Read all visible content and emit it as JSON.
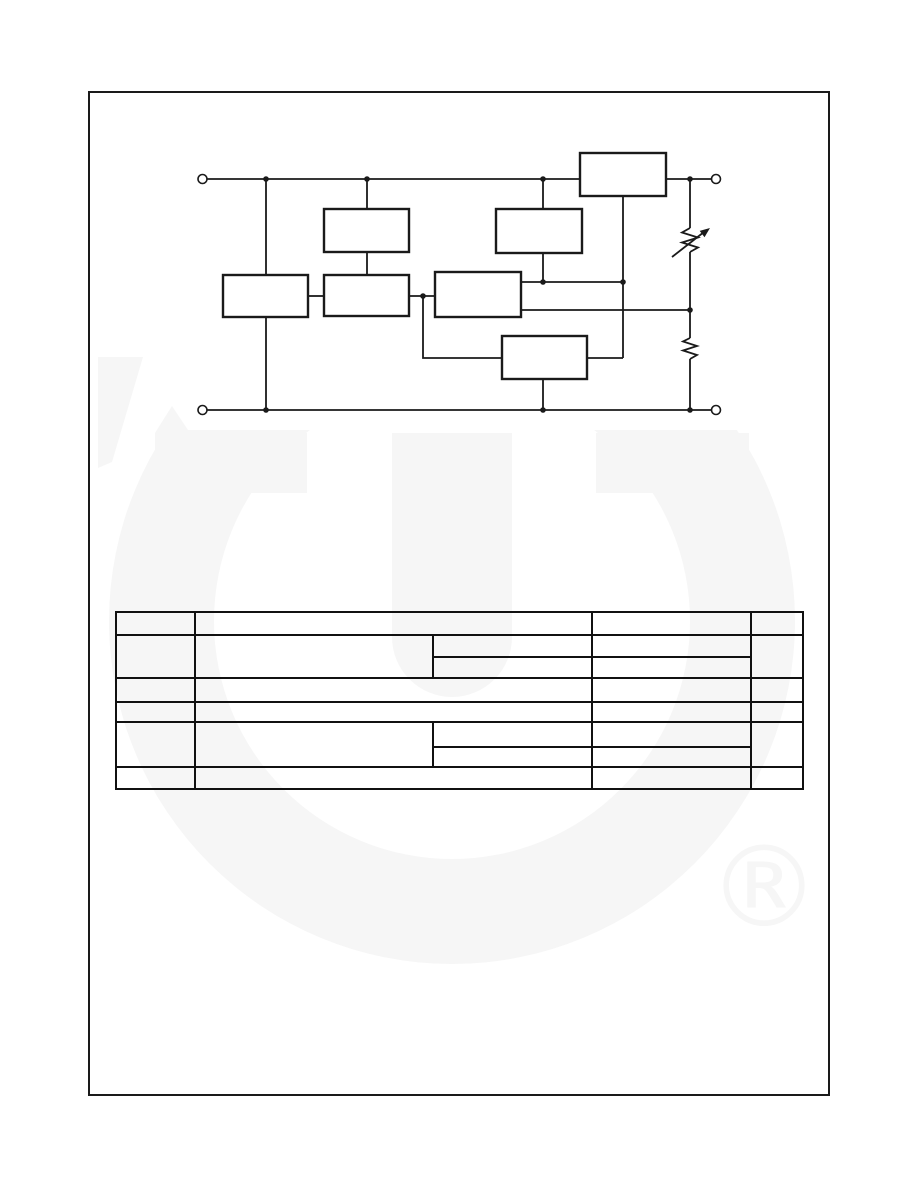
{
  "page": {
    "kind": "scanned datasheet page",
    "paper_color": "#ffffff",
    "ink_color": "#1a1a1a"
  },
  "watermark": {
    "registered_mark": "®",
    "color": "#f6f6f6"
  },
  "diagram": {
    "block_labels": [
      "",
      "",
      "",
      "",
      "",
      "",
      ""
    ],
    "terminal_count": 4,
    "has_variable_resistor": true,
    "has_fixed_resistor": true
  },
  "table": {
    "rows": 6,
    "columns": 4,
    "split_rows": [
      2,
      5
    ],
    "cell_text": ""
  }
}
